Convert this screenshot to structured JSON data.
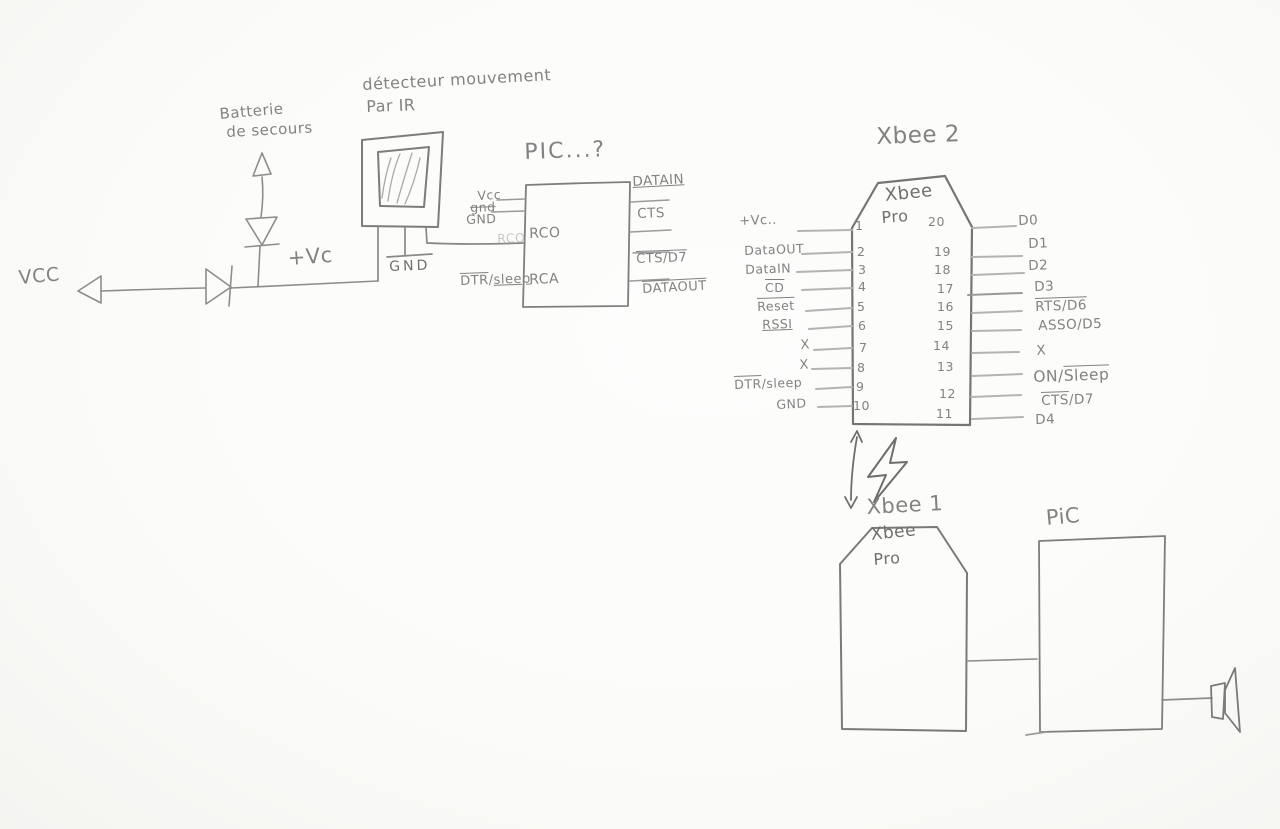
{
  "colors": {
    "paper": "#fbfbf9",
    "pencil": "#7e7e7e",
    "pencil_light": "#b3b3b3"
  },
  "power": {
    "vcc": "VCC",
    "plus_vc": "+Vc",
    "battery_line1": "Batterie",
    "battery_line2": "de secours"
  },
  "detector": {
    "title_line1": "détecteur mouvement",
    "title_line2": "Par IR",
    "gnd": "GND"
  },
  "pic1": {
    "title": "PIC...?",
    "left": {
      "vcc": "Vcc",
      "gnd_scribbled": "gnd",
      "gnd": "GND",
      "rco_faint": "RCO",
      "dtr": {
        "pre": "DTR",
        "sep": "/",
        "post": "sleep"
      }
    },
    "inner": {
      "rco": "RCO",
      "rca": "RCA"
    },
    "right": {
      "datain": "DATAIN",
      "cts": "CTS",
      "cts_d7": "CTS/D7",
      "dataout": "DATAOUT"
    }
  },
  "xbee2": {
    "title": "Xbee 2",
    "chip_line1": "Xbee",
    "chip_line2": "Pro",
    "left_pins": [
      {
        "num": "1",
        "label": "+Vc.."
      },
      {
        "num": "2",
        "label": "DataOUT"
      },
      {
        "num": "3",
        "label": "DataIN"
      },
      {
        "num": "4",
        "label": "CD"
      },
      {
        "num": "5",
        "label": "Reset"
      },
      {
        "num": "6",
        "label": "RSSI"
      },
      {
        "num": "7",
        "label": "X"
      },
      {
        "num": "8",
        "label": "X"
      },
      {
        "num": "9",
        "pre": "DTR",
        "post": "/sleep"
      },
      {
        "num": "10",
        "label": "GND"
      }
    ],
    "right_pins": [
      {
        "num": "20",
        "label": "D0"
      },
      {
        "num": "19",
        "label": "D1"
      },
      {
        "num": "18",
        "label": "D2"
      },
      {
        "num": "17",
        "label": "D3"
      },
      {
        "num": "16",
        "label": "RTS/D6"
      },
      {
        "num": "15",
        "label": "ASSO/D5"
      },
      {
        "num": "14",
        "label": "X"
      },
      {
        "num": "13",
        "pre": "ON/",
        "post": "Sleep"
      },
      {
        "num": "12",
        "pre": "CTS",
        "post": "/D7"
      },
      {
        "num": "11",
        "label": "D4"
      }
    ]
  },
  "xbee1": {
    "title": "Xbee 1",
    "chip_line1": "Xbee",
    "chip_line2": "Pro"
  },
  "pic2": {
    "title": "PiC"
  }
}
